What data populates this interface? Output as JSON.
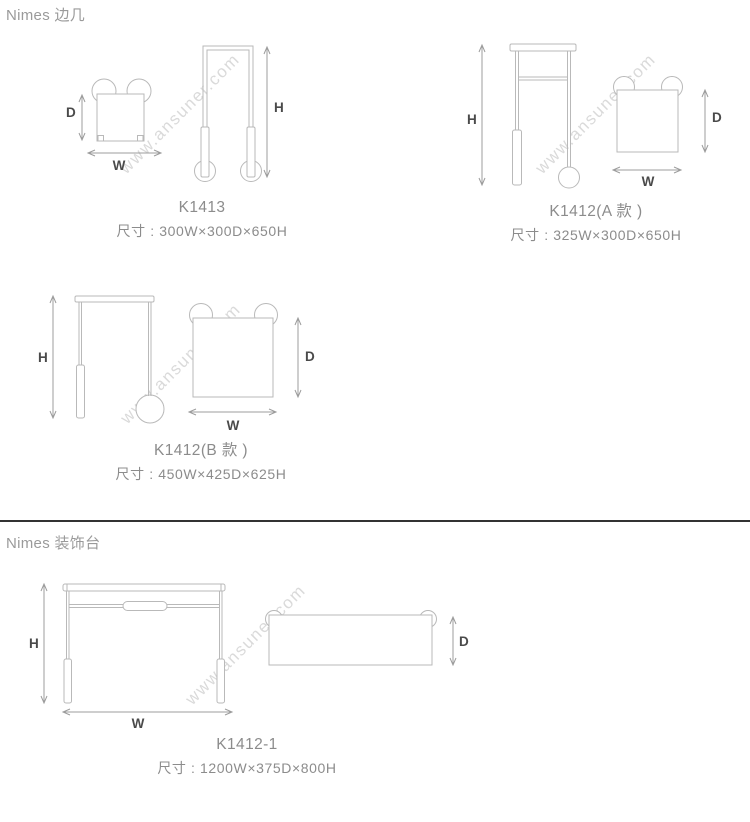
{
  "page": {
    "watermark_text": "www.ansuner.com"
  },
  "dim_labels": {
    "width": "W",
    "depth": "D",
    "height": "H"
  },
  "sections": [
    {
      "title": "Nimes 边几",
      "items": [
        {
          "model": "K1413",
          "size": "尺寸 : 300W×300D×650H"
        },
        {
          "model": "K1412(A 款 )",
          "size": "尺寸 : 325W×300D×650H"
        },
        {
          "model": "K1412(B 款 )",
          "size": "尺寸 : 450W×425D×625H"
        }
      ]
    },
    {
      "title": "Nimes 装饰台",
      "items": [
        {
          "model": "K1412-1",
          "size": "尺寸 : 1200W×375D×800H"
        }
      ]
    }
  ],
  "colors": {
    "background": "#ffffff",
    "heading_text": "#9a9a9a",
    "caption_text": "#8c8c8c",
    "dimension_label": "#4a4a4a",
    "drawing_line": "#b9b9b9",
    "dimension_line": "#9c9c9c",
    "divider": "#333333",
    "watermark": "#dadada"
  }
}
